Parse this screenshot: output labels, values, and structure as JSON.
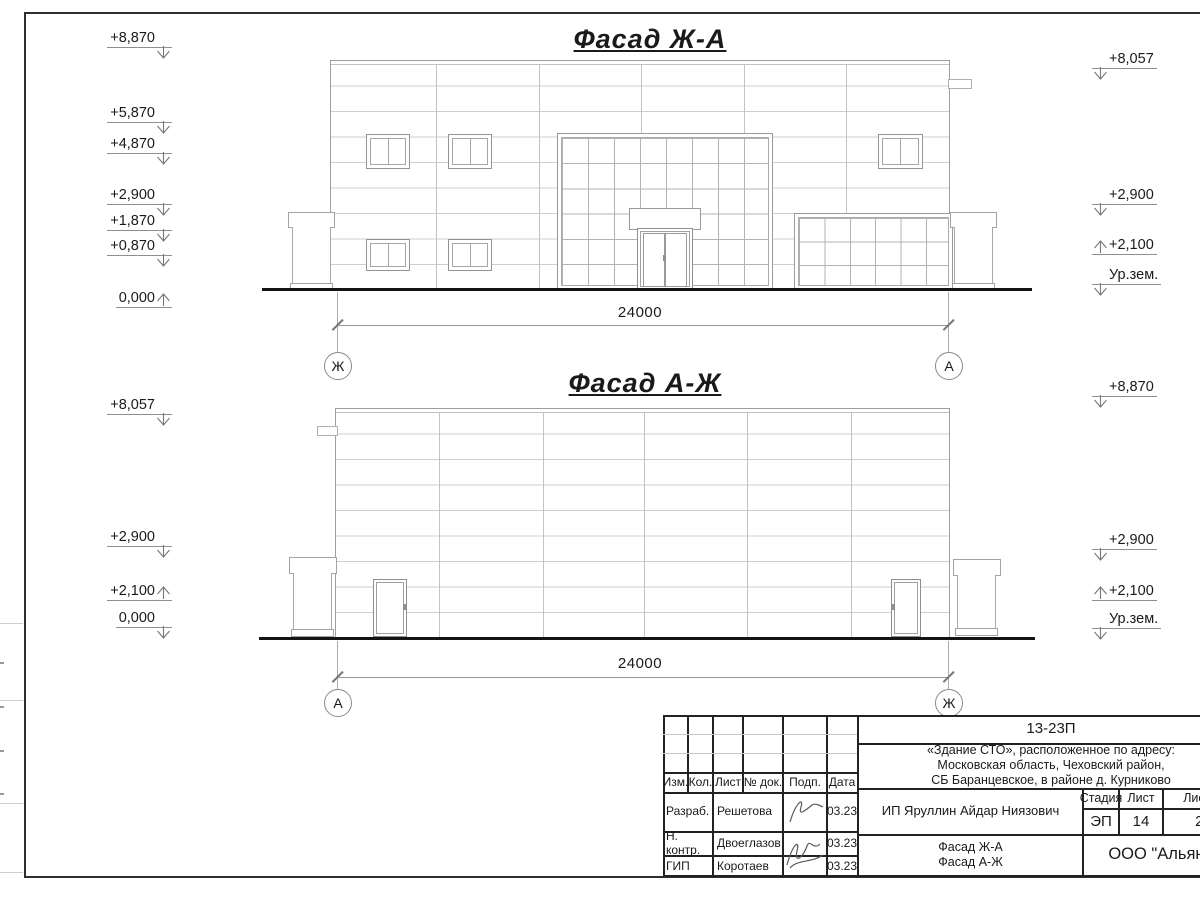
{
  "facade_top": {
    "title": "Фасад Ж-А",
    "marks_left": [
      "+8,870",
      "+5,870",
      "+4,870",
      "+2,900",
      "+1,870",
      "+0,870",
      "0,000"
    ],
    "marks_right": [
      "+8,057",
      "+2,900",
      "+2,100",
      "Ур.зем."
    ],
    "dimension": "24000",
    "axis_left": "Ж",
    "axis_right": "А"
  },
  "facade_bottom": {
    "title": "Фасад А-Ж",
    "marks_left": [
      "+8,057",
      "+2,900",
      "+2,100",
      "0,000"
    ],
    "marks_right": [
      "+8,870",
      "+2,900",
      "+2,100",
      "Ур.зем."
    ],
    "dimension": "24000",
    "axis_left": "А",
    "axis_right": "Ж"
  },
  "title_block": {
    "doc_code": "13-23П",
    "address_lines": [
      "«Здание СТО», расположенное по адресу:",
      "Московская область, Чеховский район,",
      "СБ Баранцевское, в районе д. Курниково"
    ],
    "col_headers": {
      "izm": "Изм.",
      "kol": "Кол.",
      "list": "Лист",
      "ndok": "№ док.",
      "podp": "Подп.",
      "data": "Дата"
    },
    "rows": [
      {
        "role": "Разраб.",
        "name": "Решетова",
        "date": "03.23"
      },
      {
        "role": "Н. контр.",
        "name": "Двоеглазов",
        "date": "03.23"
      },
      {
        "role": "ГИП",
        "name": "Коротаев",
        "date": "03.23"
      }
    ],
    "client": "ИП Яруллин Айдар Ниязович",
    "stage_label": "Стадия",
    "sheet_label": "Лист",
    "sheets_label": "Листов",
    "stage": "ЭП",
    "sheet_number": "14",
    "sheets_total": "22",
    "sheet_titles": [
      "Фасад Ж-А",
      "Фасад А-Ж"
    ],
    "company": "ООО \"Альянс\""
  }
}
